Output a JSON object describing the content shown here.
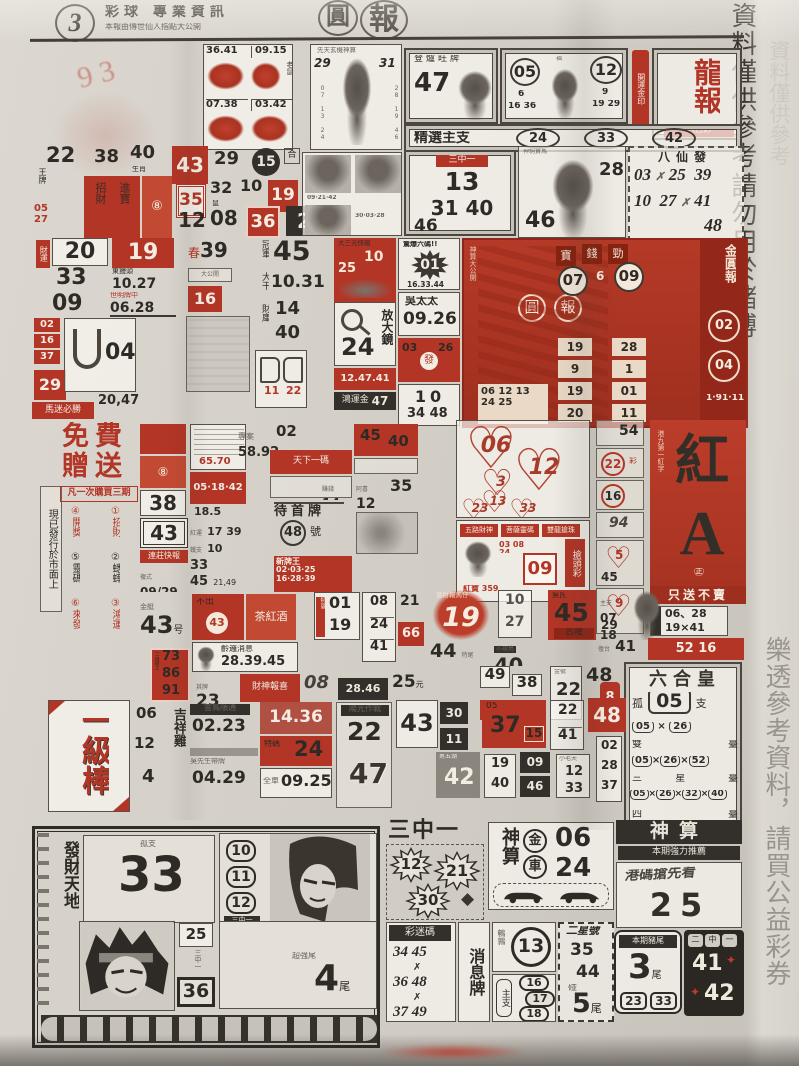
{
  "meta": {
    "page_num": "3",
    "title": "彩球 專業資訊",
    "subtitle": "本報由傳世仙人指點大公開",
    "logo_a": "圓",
    "logo_b": "報",
    "margin_top_1": "資料僅供參考",
    "margin_top_2": "請勿用於賭博",
    "margin_bottom": "樂透參考資料，請買公益彩券",
    "scribble": "9 3"
  },
  "a": {
    "g11": "36.41",
    "g12": "09.15",
    "g21": "07.38",
    "g22": "03.42",
    "gtag": "老鼠",
    "deity_head": "先天玄機神算",
    "deity_l": "29",
    "deity_r": "31",
    "deity_s1": "07 13 24",
    "deity_s2": "28 19 46",
    "stove_head": "登爐旺牌",
    "stove_num": "47",
    "p_n1": "05",
    "p_s1": "6",
    "p_s1b": "16 36",
    "p_mid": "福",
    "p_n2": "12",
    "p_s2": "9",
    "p_s2b": "19 29",
    "seal": "開運金印",
    "long_t": "龍報",
    "long_s": "六合彩",
    "pick": "精選主支",
    "pick1": "24",
    "pick2": "33",
    "pick3": "42"
  },
  "b": {
    "n22": "22",
    "t22": "王牌",
    "n38": "38",
    "n40": "40",
    "t40": "生肖",
    "n43": "43",
    "n29": "29",
    "n15": "15",
    "the": "合",
    "r1": "招財",
    "r2": "進寶",
    "r3": "⑧",
    "n35": "35",
    "n32": "32",
    "t32": "鼠",
    "n10": "10",
    "n19": "19",
    "m1": "05",
    "m2": "27",
    "n12": "12",
    "n08": "08",
    "n36": "36",
    "n2": "2",
    "t2": "碼",
    "ph1": "09·21·42",
    "ph2": "30·03·28",
    "san_t": "三中一",
    "san1": "13",
    "san2": "31 40",
    "san3": "46",
    "horse_head": "神駒寶馬",
    "horse1": "28",
    "horse2": "46",
    "ba_t": "八仙發",
    "ba1": "03",
    "ba2": "25",
    "ba3": "39",
    "ba4": "10",
    "ba5": "27",
    "ba6": "41",
    "ba7": "48",
    "bax": "✗"
  },
  "c": {
    "t20": "財運",
    "n20": "20",
    "n19": "19",
    "n33": "33",
    "t27": "東饅頭",
    "n1027": "10.27",
    "n09": "09",
    "t0628": "世明牌中",
    "n0628": "06.28",
    "a1": "02",
    "a2": "16",
    "a3": "37",
    "n29": "29",
    "band29": "馬迷必勝",
    "u04": "04",
    "n2047": "20,47",
    "s39a": "春",
    "s39b": "39",
    "s16": "16",
    "sgray": "大公開",
    "champ_t": "冠軍",
    "champ_n": "45",
    "dagan_t": "大干",
    "dagan_n": "10.31",
    "caiku_t": "財庫",
    "caiku1": "14",
    "caiku2": "40",
    "bk1": "11",
    "bk2": "22",
    "ship_h": "大三元快報",
    "ship1": "10",
    "ship2": "25",
    "mag_n": "24",
    "mag_t": "放大鏡",
    "band1": "12.47.41",
    "gold_t": "鴻運金",
    "gold_n": "47",
    "star_h": "驚爆六碼!!",
    "star_n": "01",
    "star_s": "16.33.44",
    "wu_t": "吳太太",
    "wu_n": "09.26",
    "rb1": "03",
    "rb2": "26",
    "rb3": "發",
    "ten_n": "10",
    "ten_s": "34 48",
    "j_side": "神算大公開",
    "j_lg1": "圓",
    "j_lg2": "報",
    "j_h1": "寶",
    "j_h2": "錢",
    "j_h3": "勁",
    "j_c1": "07",
    "j_c1b": "6",
    "j_c2": "09",
    "j_p1a": "19",
    "j_p1b": "28",
    "j_p2a": "9",
    "j_p2b": "1",
    "j_p3a": "19",
    "j_p3b": "01",
    "j_p4a": "20",
    "j_p4b": "11",
    "j_chipa": "06 12 13",
    "j_chipb": "24 25",
    "j_v": "金圓報",
    "j_s1": "02",
    "j_s2": "04",
    "j_s3": "1·91·11"
  },
  "d": {
    "strip": "現已發行於市面上",
    "free1": "免費",
    "free2": "贈送",
    "free_band": "凡一次購買三期",
    "i1": "①招財",
    "i2": "②蟋蟀",
    "i3": "③鴻運",
    "i4": "④開獎",
    "i5": "⑤靈碼",
    "i6": "⑥來發",
    "case_t": "專案",
    "case_n": "58.92",
    "c02": "02",
    "rb_t": "天下一碼",
    "rb_n": "05·18·42",
    "n38": "38",
    "n43": "43",
    "band2": "連莊快報",
    "t0929": "複式",
    "n0929": "09/29",
    "b65": "65.70",
    "b8": "⑧",
    "b185": "18.5",
    "g17t": "紅運",
    "g17": "17 39",
    "g10t": "鐵支",
    "g10": "10",
    "g33": "33",
    "g45": "45",
    "g2149": "21,49",
    "wait_t": "待首牌",
    "wait_n": "48",
    "wait_u": "號",
    "grid_t": "新牌王",
    "gr1": "02·03·25",
    "gr2": "16·28·39",
    "r4540a": "45",
    "r4540b": "40",
    "zh_t": "賺錢",
    "zh_n": "14",
    "ax_t": "阿喜",
    "ax_n": "12",
    "n35": "35",
    "h06": "06",
    "h12": "12",
    "h3": "3",
    "h13": "13",
    "h23": "23",
    "h33": "33",
    "mh1": "五路財神",
    "mh2": "菩薩靈碼",
    "mh3": "雙龍搶珠",
    "grab": "搶頭彩",
    "m09": "09",
    "mt1": "03 08 24",
    "mt2": "紅寶 359",
    "rc54": "54",
    "rc22": "22",
    "rc22t": "彩",
    "rc16": "16",
    "rc94": "94",
    "rc5": "5",
    "rc45": "45",
    "rc9": "9",
    "rc29": "29",
    "ha1": "紅",
    "ha2": "A",
    "ha_side": "港九第一紅字",
    "ha_band": "只送不賣",
    "ha_s1": "06、28",
    "ha_s2": "19×41",
    "ha_seal": "㊣"
  },
  "e": {
    "jin_t": "金艇",
    "jin_n": "43",
    "jin_u": "号",
    "re1": "不出",
    "re1n": "43",
    "re2": "茶紅酒",
    "msg_t": "齡邏消息",
    "msg_n": "28.39.45",
    "n73": "73",
    "n86": "86",
    "n91": "91",
    "t73": "三連王",
    "n23": "23",
    "t23": "其牌",
    "re3": "財神報喜",
    "n08": "08",
    "n2846": "28.46",
    "n25": "25",
    "t25": "元",
    "p01": "01",
    "p19": "19",
    "p08": "08",
    "p24": "24",
    "p41": "41",
    "p21": "21",
    "p66": "66",
    "tchip": "特區",
    "c19": "19",
    "c19t": "發財報馬仔",
    "s10": "10",
    "s27": "27",
    "r45": "45",
    "r45t": "吉隆",
    "r45h": "吳氏",
    "s07": "07",
    "s18": "18",
    "s0718t": "主支",
    "n44": "44",
    "t44": "特尾",
    "n40": "40",
    "t40": "小現鳥",
    "n41": "41",
    "t41": "復台",
    "band52": "52 16",
    "n49": "49",
    "n38": "38",
    "n22": "22",
    "t22": "金號",
    "n48": "48",
    "r05": "05",
    "r8": "8",
    "c1": "02",
    "c2": "28",
    "c3": "37",
    "lh_t": "六合皇",
    "lh_gu": "孤",
    "lh_n": "05",
    "lh_zhi": "支",
    "lh_a1": "05",
    "lh_a2": "26",
    "lh_cap1": "雙",
    "lh_cap1b": "臺",
    "lh_b1": "05",
    "lh_b2": "26",
    "lh_b3": "52",
    "lh_cap2": "三",
    "lh_cap2b": "星",
    "lh_cap2c": "臺",
    "lh_c1": "05",
    "lh_c2": "26",
    "lh_c3": "32",
    "lh_c4": "40",
    "lh_cap3": "四",
    "lh_cap3b": "臺",
    "lh_x": "×"
  },
  "f": {
    "y1": "一",
    "y2": "級",
    "y3": "棒",
    "l06": "06",
    "l12": "12",
    "l4": "4",
    "lt": "吉祥雞",
    "yun_t": "雲鳥順通",
    "yun_n": "02.23",
    "wu_t": "吳先生帶牌",
    "wu_n": "04.29",
    "n1436": "14.36",
    "t24": "特碼",
    "n24": "24",
    "t0925": "全車",
    "n0925": "09.25",
    "sun_t": "陽光作戰",
    "sun1": "22",
    "sun2": "47",
    "f43": "43",
    "f30": "30",
    "f11": "11",
    "f42t": "男五湖",
    "f42": "42",
    "rb05": "05",
    "rb37": "37",
    "rb15": "15",
    "f19": "19",
    "f40": "40",
    "f09": "09",
    "f46": "46",
    "f12t": "小毛夫",
    "f12": "12",
    "f33": "33",
    "f22": "22",
    "f41": "41",
    "f48": "48"
  },
  "g": {
    "fa": "發財天地",
    "gu_t": "孤支",
    "gu_n": "33",
    "p10": "10",
    "p11": "11",
    "p12": "12",
    "san1": "三中一",
    "s25": "25",
    "san2": "三中一",
    "s36": "36",
    "tail_t": "超強尾",
    "tail_n": "4",
    "tail_u": "尾",
    "head": "三中一",
    "st12": "12",
    "st21": "21",
    "st30": "30",
    "dia": "◆",
    "god_t": "神算",
    "god_j": "金",
    "god_c": "車",
    "god1": "06",
    "god2": "24",
    "cm_t": "彩迷碼",
    "cm1": "34 45",
    "cm2": "36 48",
    "cm3": "37 49",
    "cmx1": "✗",
    "cmx2": "✗",
    "news": "消息牌",
    "q_t": "鵪鶉",
    "q_n": "13",
    "zhu_t": "主支",
    "z16": "16",
    "z17": "17",
    "z18": "18",
    "ex_t": "二星號",
    "ex1": "35",
    "ex2": "44",
    "ex_p": "碰",
    "ex3": "5",
    "ex_u": "尾",
    "s2_t": "神算",
    "s2_band": "本期強力推薦",
    "s2_sl": "港碼搶先看",
    "s2_n": "25",
    "pig_t": "本期豬尾",
    "pig_n": "3",
    "pig_u": "尾",
    "pig1": "23",
    "pig2": "33",
    "dk_t1": "二",
    "dk_t2": "中",
    "dk_t3": "一",
    "dk1": "41",
    "dk2": "42",
    "dk_s": "✦"
  }
}
